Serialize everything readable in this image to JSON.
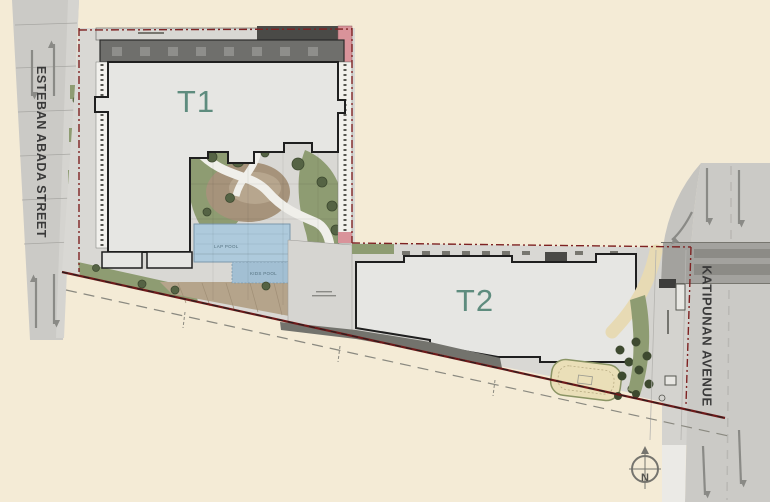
{
  "site_plan": {
    "tower1_label": "T1",
    "tower2_label": "T2",
    "street_left_label": "ESTEBAN ABADA STREET",
    "street_right_label": "KATIPUNAN AVENUE",
    "lap_pool_label": "LAP POOL",
    "kids_pool_label": "KIDS POOL",
    "north_indicator": "N"
  },
  "colors": {
    "background_cream": "#F4EBD6",
    "road_gray": "#CBCAC6",
    "sidewalk_gray": "#D9D8D4",
    "building_fill": "#E6E6E3",
    "podium_dark": "#6F6F6C",
    "landscape_green": "#8E9C72",
    "tree_dark_green": "#3E4A30",
    "pool_blue": "#AECADC",
    "pool_kids_blue": "#A2BFD3",
    "property_line_red": "#7E2222",
    "tower_label_teal": "#5E8C7E",
    "accent_pink": "#D9939A"
  }
}
